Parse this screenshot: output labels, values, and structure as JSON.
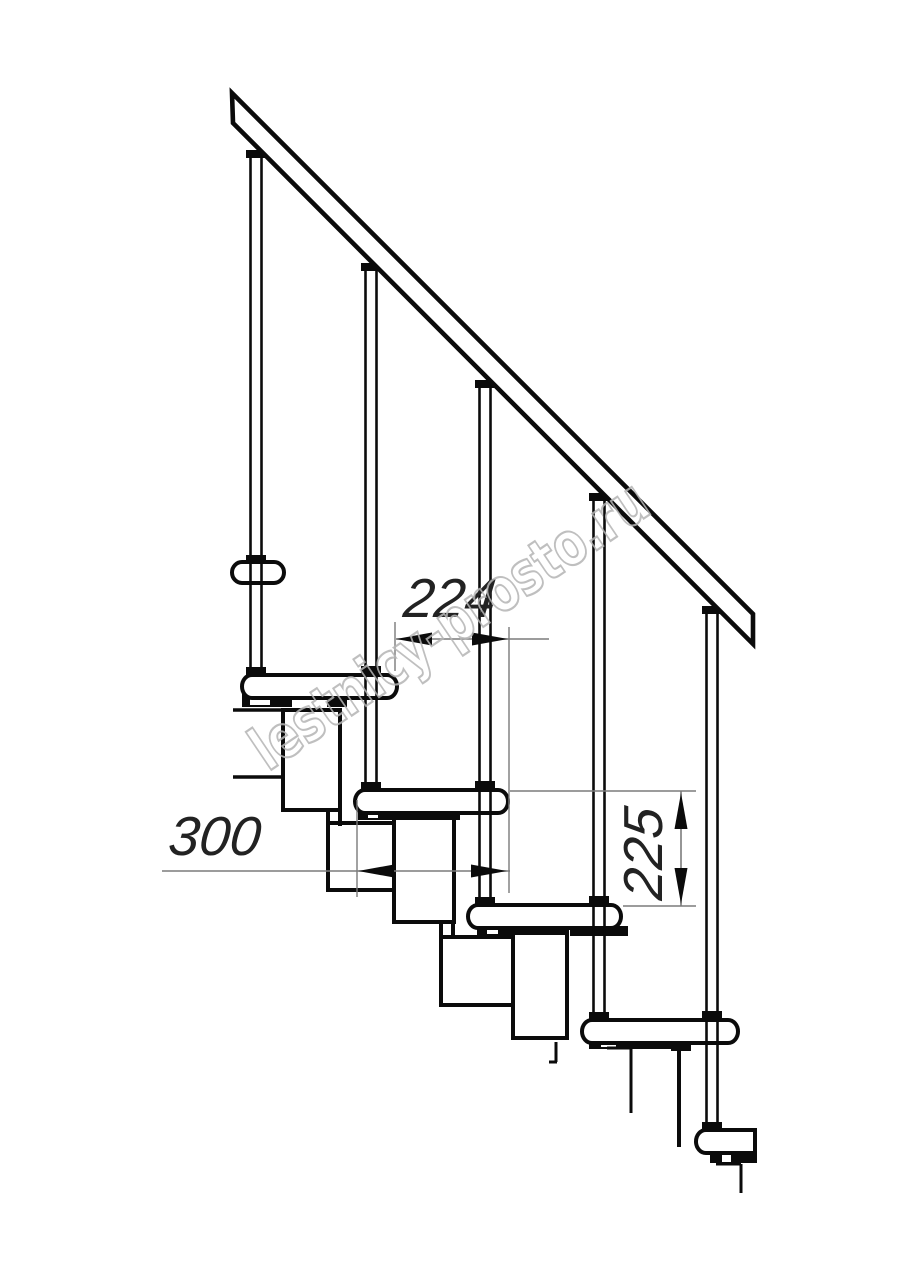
{
  "meta": {
    "width": 914,
    "height": 1280,
    "background": "#ffffff"
  },
  "style": {
    "ink": "#0b0b0b",
    "fill": "#ffffff",
    "dim_line_color": "#7b7b7b",
    "dim_text_color": "#222222",
    "dim_font_size": 55,
    "arrow_len": 36,
    "arrow_half_w": 6.5
  },
  "watermark": {
    "text": "lestnicy-prosto.ru",
    "x": 268,
    "y": 772,
    "angle": -34,
    "font_size": 60,
    "length": 465,
    "stroke": "#b5b5b5",
    "stroke_width": 2.2,
    "opacity": 0.85
  },
  "handrail": {
    "points": [
      [
        232,
        93
      ],
      [
        753,
        614
      ],
      [
        753,
        644
      ],
      [
        233,
        123
      ]
    ],
    "stroke_w": 4.6
  },
  "landing_lines": [
    [
      233,
      710,
      290,
      710
    ],
    [
      290,
      710,
      290,
      777
    ],
    [
      233,
      777,
      290,
      777
    ]
  ],
  "modules": [
    [
      283,
      710,
      57,
      100
    ],
    [
      328,
      823,
      72,
      67
    ],
    [
      394,
      818,
      60,
      104
    ],
    [
      441,
      937,
      79,
      68
    ],
    [
      513,
      927,
      54,
      111
    ]
  ],
  "module_stroke": 4,
  "necks": [
    [
      328,
      812,
      328,
      826
    ],
    [
      340,
      812,
      340,
      826
    ],
    [
      441,
      920,
      441,
      939
    ],
    [
      453,
      920,
      453,
      939
    ]
  ],
  "treads": [
    {
      "x": 242,
      "y": 675,
      "w": 155,
      "h": 23,
      "round_left": true,
      "round_right": true
    },
    {
      "x": 355,
      "y": 790,
      "w": 153,
      "h": 23,
      "round_left": true,
      "round_right": true
    },
    {
      "x": 468,
      "y": 905,
      "w": 153,
      "h": 23,
      "round_left": true,
      "round_right": true
    },
    {
      "x": 582,
      "y": 1020,
      "w": 156,
      "h": 23,
      "round_left": true,
      "round_right": true
    },
    {
      "x": 696,
      "y": 1130,
      "w": 59,
      "h": 23,
      "round_left": true,
      "round_right": false
    }
  ],
  "crossbar": {
    "x": 232,
    "y": 562,
    "w": 52,
    "h": 21
  },
  "tread_stroke": 4,
  "brackets": [
    [
      242,
      694,
      50,
      13
    ],
    [
      327,
      695,
      20,
      12
    ],
    [
      358,
      809,
      102,
      11
    ],
    [
      477,
      924,
      92,
      11
    ],
    [
      570,
      926,
      58,
      10
    ],
    [
      589,
      1040,
      102,
      9
    ],
    [
      671,
      1041,
      20,
      10
    ],
    [
      710,
      1151,
      47,
      12
    ]
  ],
  "bracket_notches": [
    [
      250,
      698,
      20,
      7
    ],
    [
      368,
      812,
      10,
      6
    ],
    [
      487,
      928,
      11,
      6
    ],
    [
      601,
      1040,
      15,
      7
    ],
    [
      722,
      1155,
      9,
      7
    ]
  ],
  "break_lines": [
    [
      556,
      1042,
      556,
      1062,
      3
    ],
    [
      549,
      1062,
      557,
      1062,
      3
    ],
    [
      607,
      1048,
      631,
      1048,
      3
    ],
    [
      631,
      1048,
      631,
      1113,
      3
    ],
    [
      679,
      1042,
      679,
      1147,
      4
    ],
    [
      716,
      1164,
      741,
      1164,
      3
    ],
    [
      741,
      1164,
      741,
      1193,
      3
    ]
  ],
  "baluster_style": {
    "half_gap": 5.5,
    "line_w": 2.6,
    "collar_w": 20
  },
  "balusters": [
    {
      "cx": 256,
      "top": 158,
      "bottom": 675,
      "collars": [
        [
          150,
          8
        ],
        [
          555,
          7
        ],
        [
          667,
          8
        ]
      ]
    },
    {
      "cx": 371,
      "top": 271,
      "bottom": 790,
      "collars": [
        [
          263,
          8
        ],
        [
          666,
          9
        ],
        [
          782,
          8
        ]
      ]
    },
    {
      "cx": 485,
      "top": 388,
      "bottom": 905,
      "collars": [
        [
          380,
          8
        ],
        [
          781,
          9
        ],
        [
          897,
          8
        ]
      ]
    },
    {
      "cx": 599,
      "top": 501,
      "bottom": 1020,
      "collars": [
        [
          493,
          8
        ],
        [
          896,
          9
        ],
        [
          1012,
          8
        ]
      ]
    },
    {
      "cx": 712,
      "top": 614,
      "bottom": 1130,
      "collars": [
        [
          606,
          8
        ],
        [
          1011,
          9
        ],
        [
          1122,
          8
        ]
      ]
    }
  ],
  "dimensions": [
    {
      "id": "dimension-224",
      "value": "224",
      "orient": "h",
      "line": [
        396,
        639,
        549,
        639
      ],
      "arrows": [
        {
          "x": 396,
          "y": 639,
          "dir": "left"
        },
        {
          "x": 508,
          "y": 639,
          "dir": "right"
        }
      ],
      "ext": [
        [
          395,
          622,
          395,
          671
        ],
        [
          509,
          627,
          509,
          893
        ]
      ],
      "text": {
        "x": 448,
        "y": 617
      }
    },
    {
      "id": "dimension-300",
      "value": "300",
      "orient": "h",
      "line": [
        162,
        871,
        510,
        871
      ],
      "arrows": [
        {
          "x": 358,
          "y": 871,
          "dir": "left"
        },
        {
          "x": 507,
          "y": 871,
          "dir": "right"
        }
      ],
      "ext": [
        [
          357,
          800,
          357,
          897
        ]
      ],
      "text": {
        "x": 213,
        "y": 855
      }
    },
    {
      "id": "dimension-225",
      "value": "225",
      "orient": "v",
      "line": [
        681,
        791,
        681,
        906
      ],
      "arrows": [
        {
          "x": 681,
          "y": 793,
          "dir": "up"
        },
        {
          "x": 681,
          "y": 904,
          "dir": "down"
        }
      ],
      "ext": [
        [
          510,
          791,
          696,
          791
        ],
        [
          623,
          906,
          696,
          906
        ]
      ],
      "text": {
        "x": 662,
        "y": 855
      }
    }
  ]
}
